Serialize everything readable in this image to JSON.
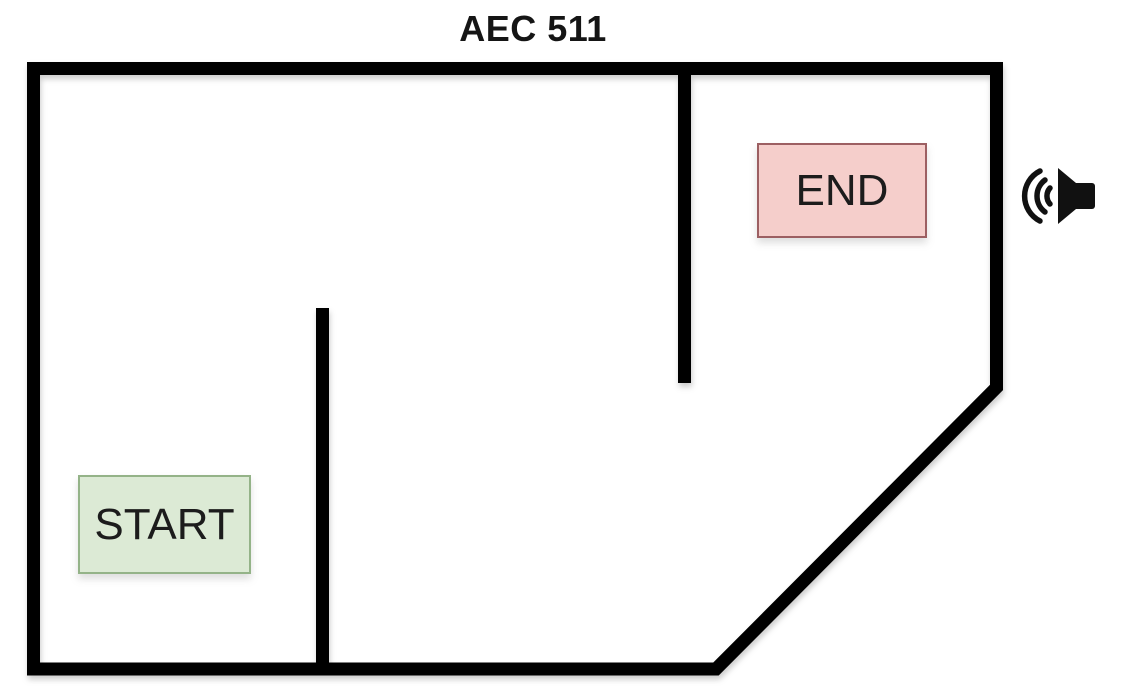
{
  "diagram": {
    "title": "AEC 511",
    "start": {
      "label": "START",
      "fill": "#dcead5",
      "border": "#94b388"
    },
    "end": {
      "label": "END",
      "fill": "#f5cecb",
      "border": "#9c5f62"
    },
    "speaker": {
      "icon": "speaker-sound-waves-icon",
      "color": "#111111"
    },
    "colors": {
      "wall": "#000000",
      "background": "#ffffff",
      "text": "#151515"
    }
  }
}
